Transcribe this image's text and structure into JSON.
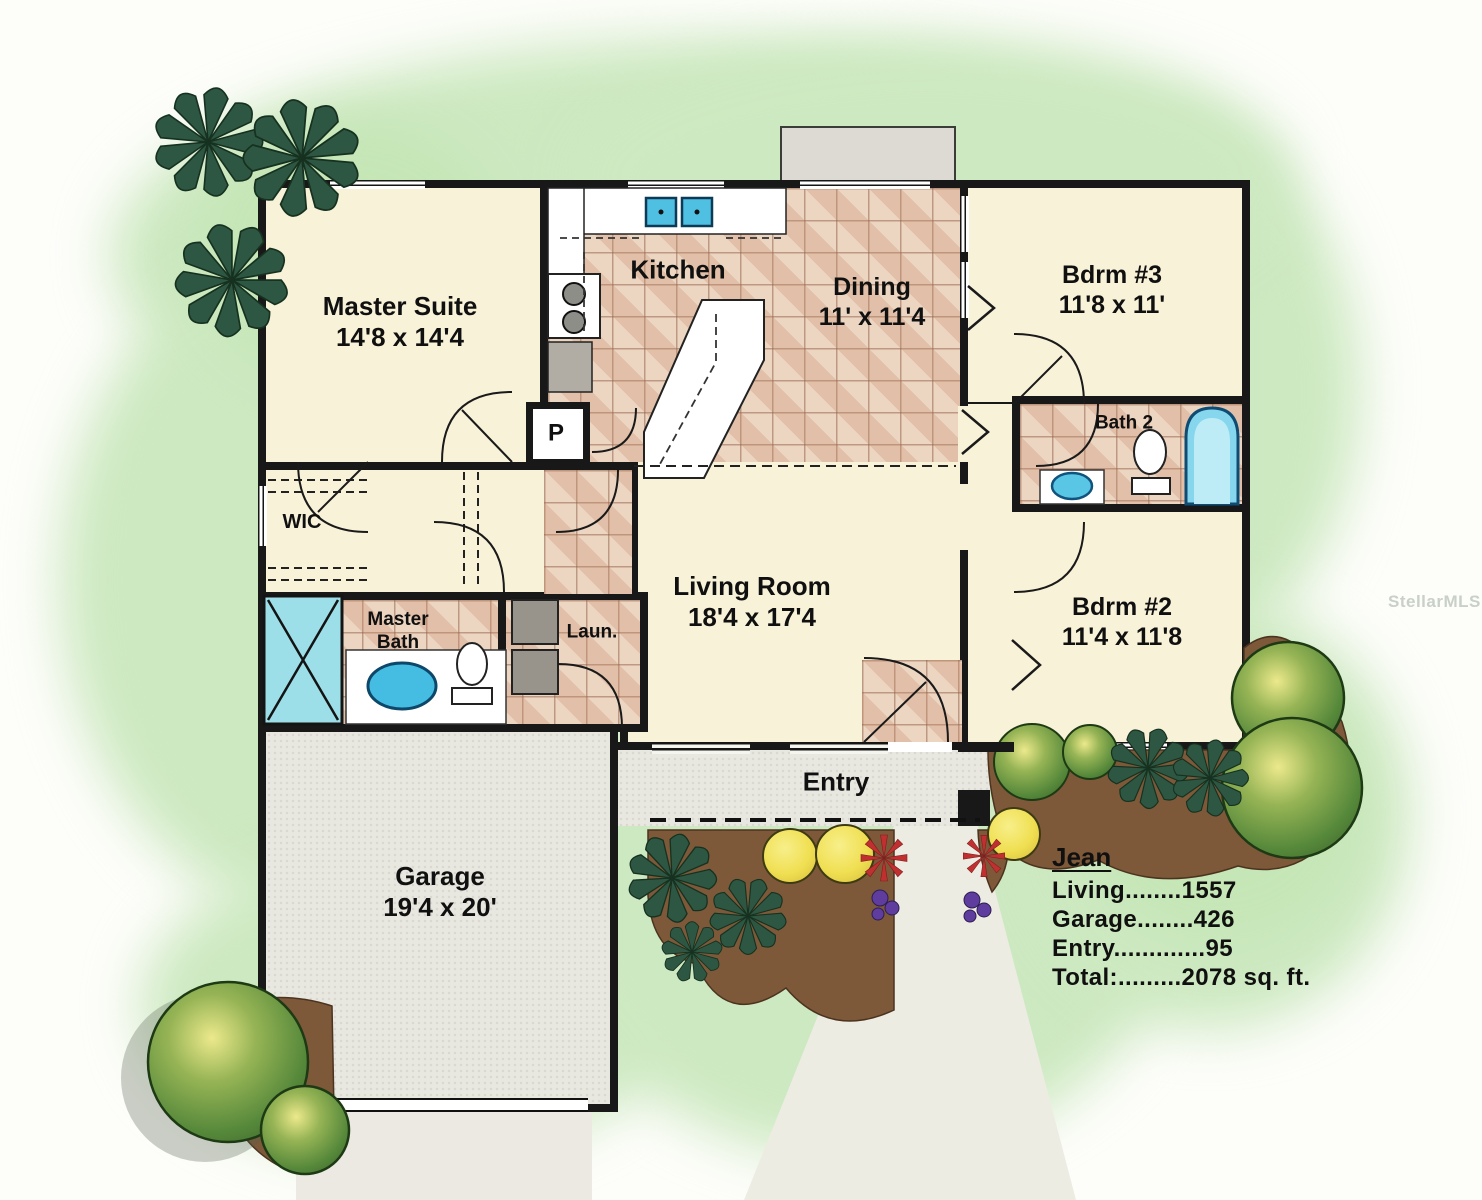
{
  "watermark": "StellarMLS",
  "rooms": {
    "master_suite": {
      "name": "Master Suite",
      "dims": "14'8 x 14'4"
    },
    "kitchen": {
      "name": "Kitchen"
    },
    "dining": {
      "name": "Dining",
      "dims": "11' x 11'4"
    },
    "bdrm3": {
      "name": "Bdrm #3",
      "dims": "11'8 x 11'"
    },
    "bath2": {
      "name": "Bath 2"
    },
    "bdrm2": {
      "name": "Bdrm #2",
      "dims": "11'4 x 11'8"
    },
    "living": {
      "name": "Living Room",
      "dims": "18'4 x 17'4"
    },
    "wic": {
      "name": "WIC"
    },
    "master_bath": {
      "name": "Master Bath"
    },
    "laundry": {
      "name": "Laun."
    },
    "pantry": {
      "name": "P"
    },
    "entry": {
      "name": "Entry"
    },
    "garage": {
      "name": "Garage",
      "dims": "19'4 x 20'"
    }
  },
  "legend": {
    "title": "Jean",
    "lines": [
      "Living........1557",
      "Garage........426",
      "Entry.............95",
      "Total:.........2078  sq. ft."
    ]
  },
  "colors": {
    "wall": "#181818",
    "room_cream": "#f8f2d8",
    "tile_floor": "#ecd6c2",
    "concrete_gray": "#e9e8e0",
    "lawn_green": "#cde9c1",
    "mulch_brown": "#7d5939",
    "water_blue": "#5ac6e6",
    "tree_green": "#57893b",
    "palm_green": "#2e5743",
    "bush_yellow": "#f0df52",
    "flower_red": "#c03030"
  }
}
